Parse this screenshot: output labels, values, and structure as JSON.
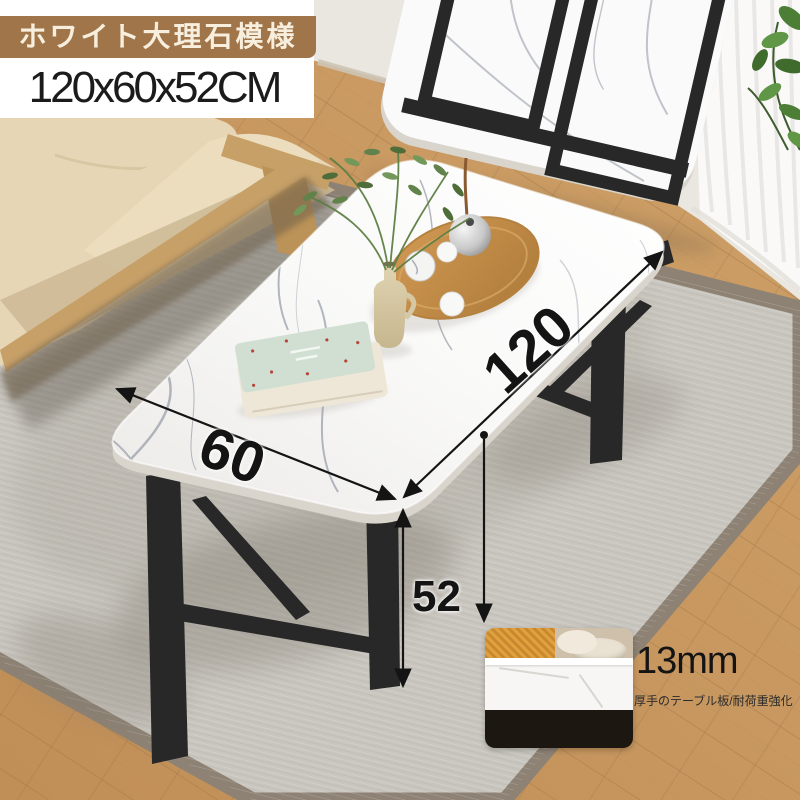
{
  "product_labels": {
    "color_badge": "ホワイト大理石模様",
    "size": "120x60x52CM"
  },
  "dimensions": {
    "length": "120",
    "width": "60",
    "height": "52"
  },
  "thickness_callout": {
    "value": "13mm",
    "caption": "厚手のテーブル板/耐荷重強化"
  },
  "colors": {
    "badge-bg": "#a1754a",
    "badge-text": "#f7eedd",
    "size-text": "#1b1b1b",
    "annotation": "#141414",
    "floor": "#c6965e",
    "floor-seam": "#9d7343",
    "rug": "#c9c6bf",
    "rug-border": "#8d8274",
    "wall": "#eae6e0",
    "curtain": "#fbfbfa",
    "marble": "#fafafa",
    "marble-edge": "#d9d4cc",
    "marble-vein": "#9aa1ab",
    "leg": "#282828",
    "sofa": "#e7d6b6",
    "sofa-shade": "#cdb894",
    "sofa-wood": "#c7a068",
    "tray-wood": "#c08445",
    "plant-green": "#5d8040",
    "book-mint": "#d0dfd1",
    "book-cream": "#eee7d8",
    "inset-dark": "#1d1712",
    "basket-yellow": "#dfa13d"
  }
}
